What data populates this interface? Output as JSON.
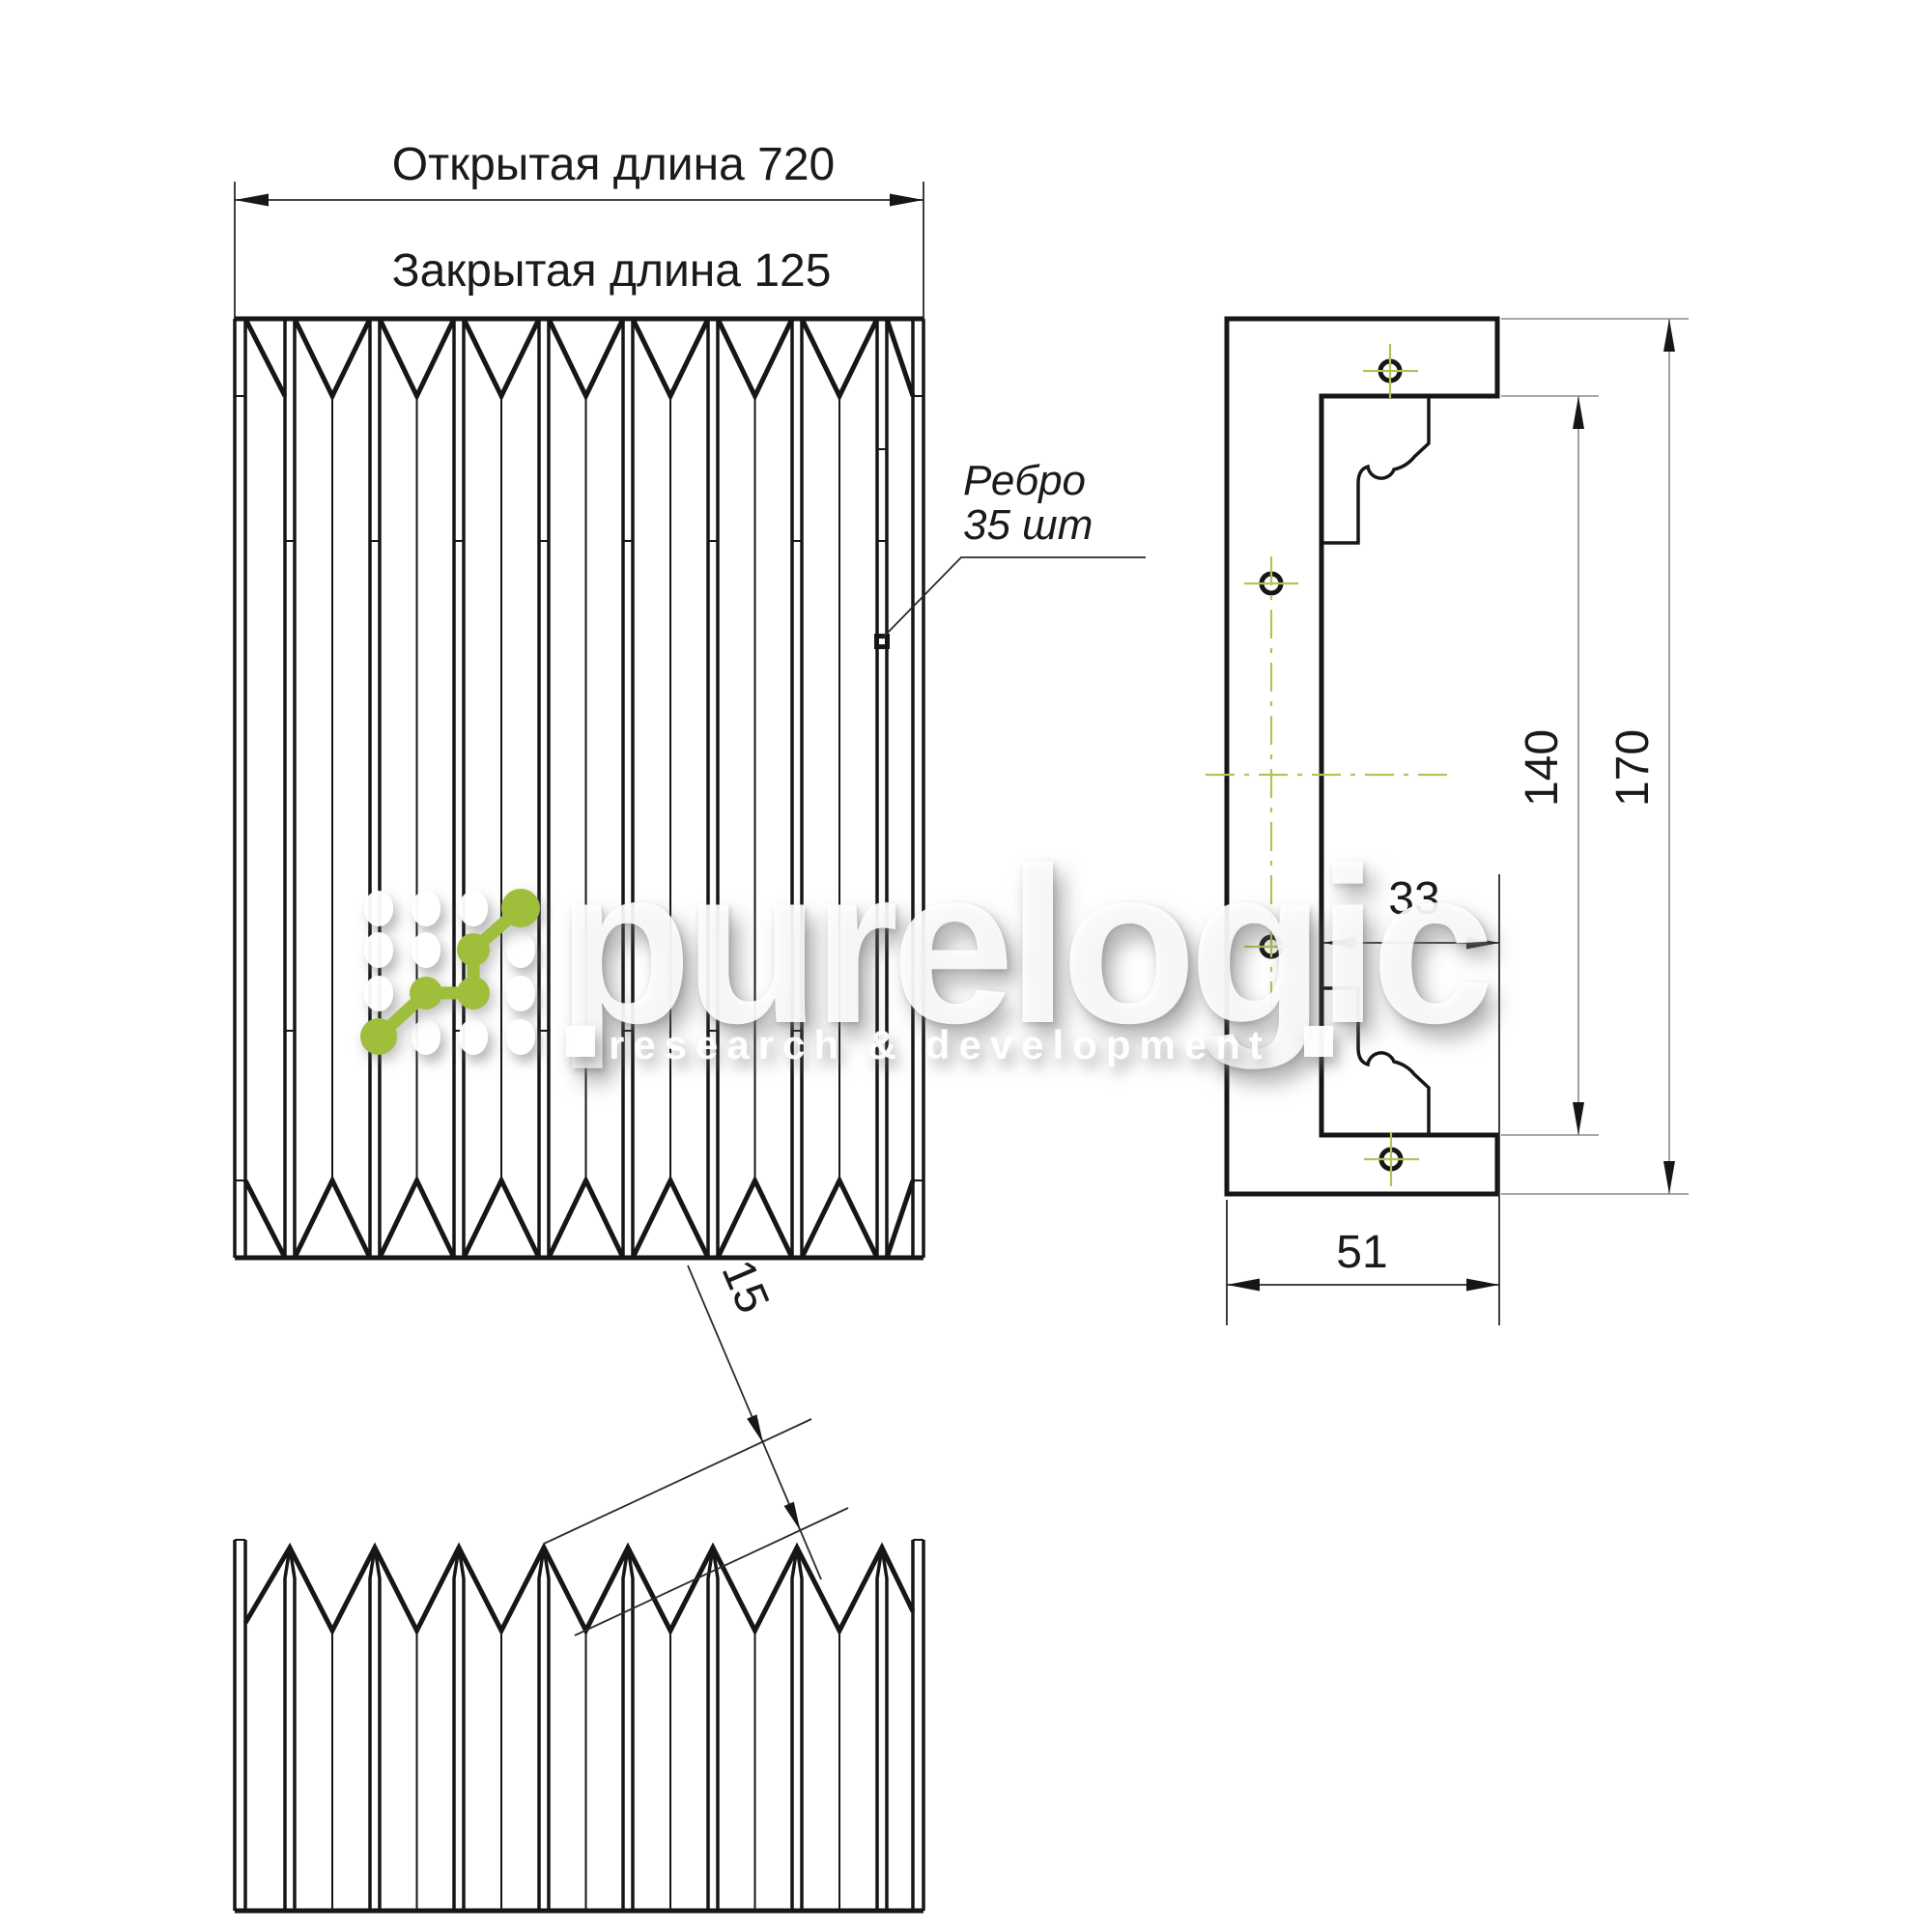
{
  "drawing": {
    "labels": {
      "open_length": "Открытая длина 720",
      "closed_length": "Закрытая длина 125",
      "rib_note_line1": "Ребро",
      "rib_note_line2": "35 шт"
    },
    "dimensions": {
      "inner_height": "140",
      "outer_height": "170",
      "inner_depth": "33",
      "outer_width": "51",
      "fold_pitch": "15"
    }
  },
  "watermark": {
    "brand": "purelogic",
    "tagline": "research & development",
    "brand_green": "#9fbe3b",
    "centerline_green": "#b5c356"
  }
}
